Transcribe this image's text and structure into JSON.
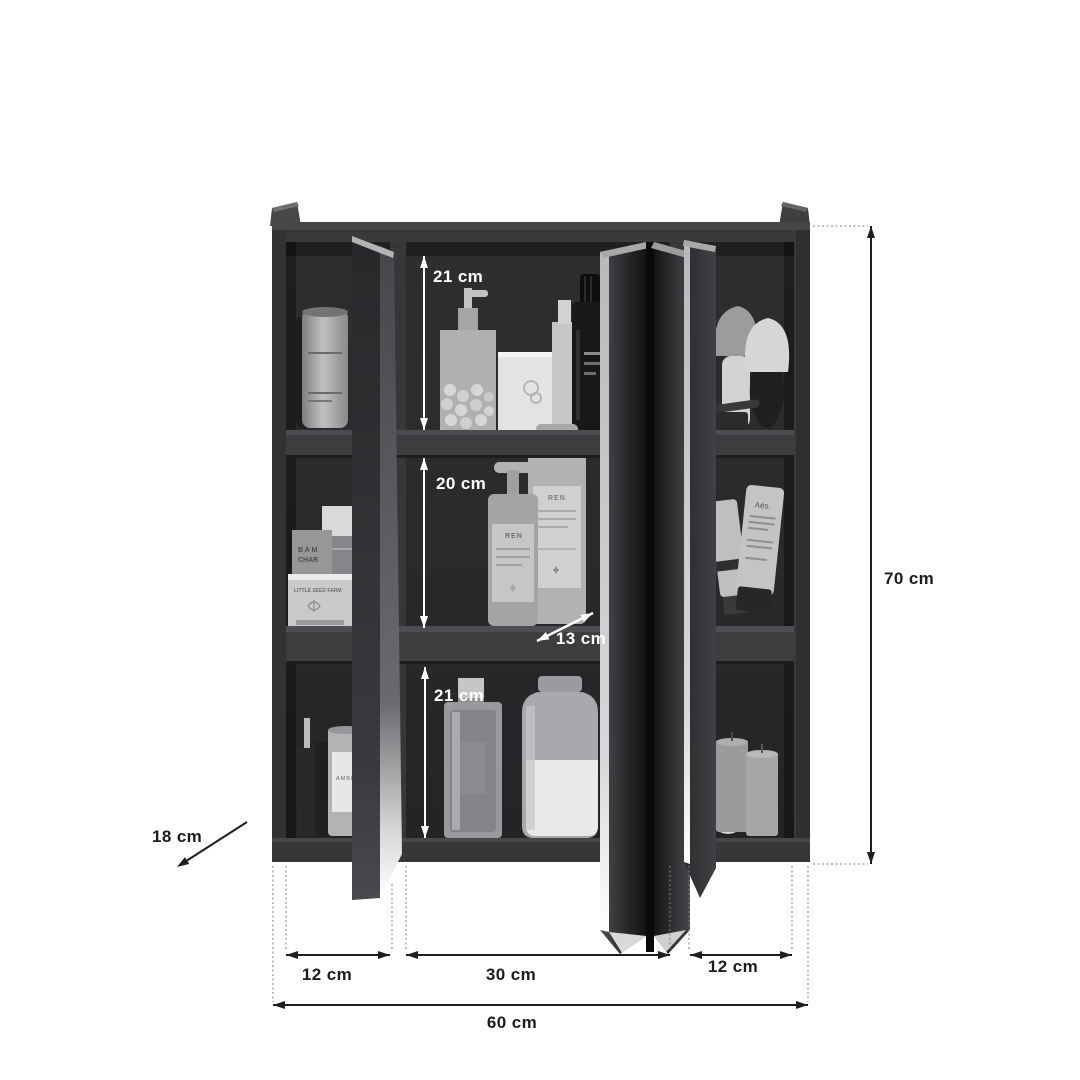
{
  "diagram": {
    "subject": "three-door bathroom wall cabinet with open mirrored doors and dimension annotations",
    "background": "#ffffff",
    "colors": {
      "cabinet_body": "#3a3a3c",
      "cabinet_interior": "#28282a",
      "shelf_face": "#3d3d40",
      "door_edge_highlight": "#e8e8ea",
      "dimension_line": "#1f1f1f",
      "annotation_on_dark": "#ffffff"
    },
    "dimensions": {
      "inner_top_height": "21 cm",
      "inner_middle_height": "20 cm",
      "inner_bottom_height": "21 cm",
      "shelf_depth": "13 cm",
      "total_height": "70 cm",
      "total_depth": "18 cm",
      "left_section_width": "12 cm",
      "middle_section_width": "30 cm",
      "right_section_width": "12 cm",
      "total_width": "60 cm"
    },
    "product_labels": {
      "bam_line1": "B A M",
      "bam_line2": "CHAR",
      "seed_box": "LITTLE SEED FARM",
      "candle": "AMBRE",
      "ren_front": "REN",
      "ren_back": "REN",
      "aesop": "Aēs."
    }
  }
}
